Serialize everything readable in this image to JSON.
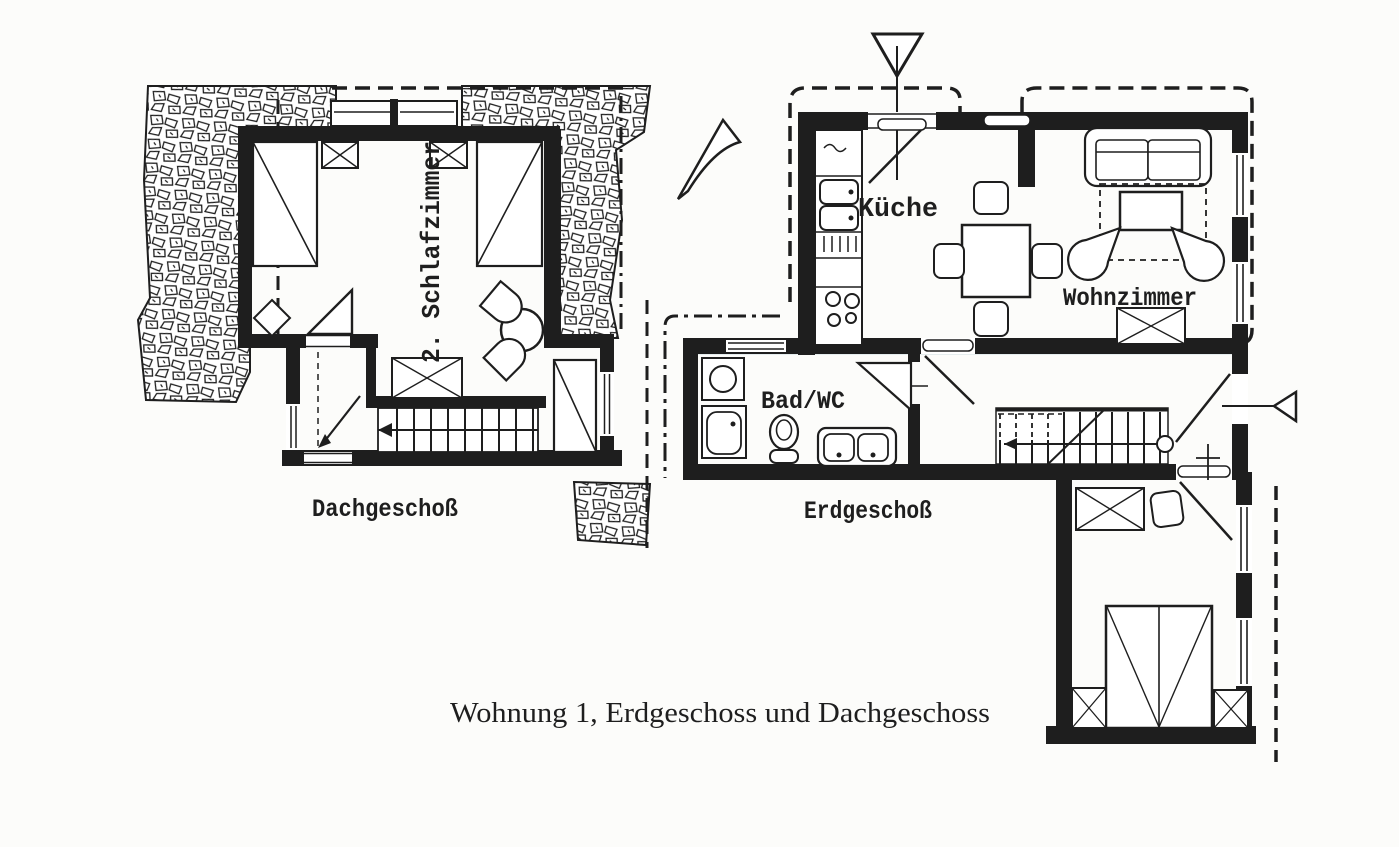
{
  "page": {
    "background": "#fcfcfa",
    "ink": "#1e1e1e"
  },
  "caption": {
    "text": "Wohnung 1, Erdgeschoss und Dachgeschoss"
  },
  "plans": {
    "dachgeschoss": {
      "floor_label": "Dachgeschoß",
      "room_label": "2. Schlafzimmer"
    },
    "erdgeschoss": {
      "floor_label": "Erdgeschoß",
      "kitchen_label": "Küche",
      "living_label": "Wohnzimmer",
      "bath_label": "Bad/WC"
    }
  }
}
